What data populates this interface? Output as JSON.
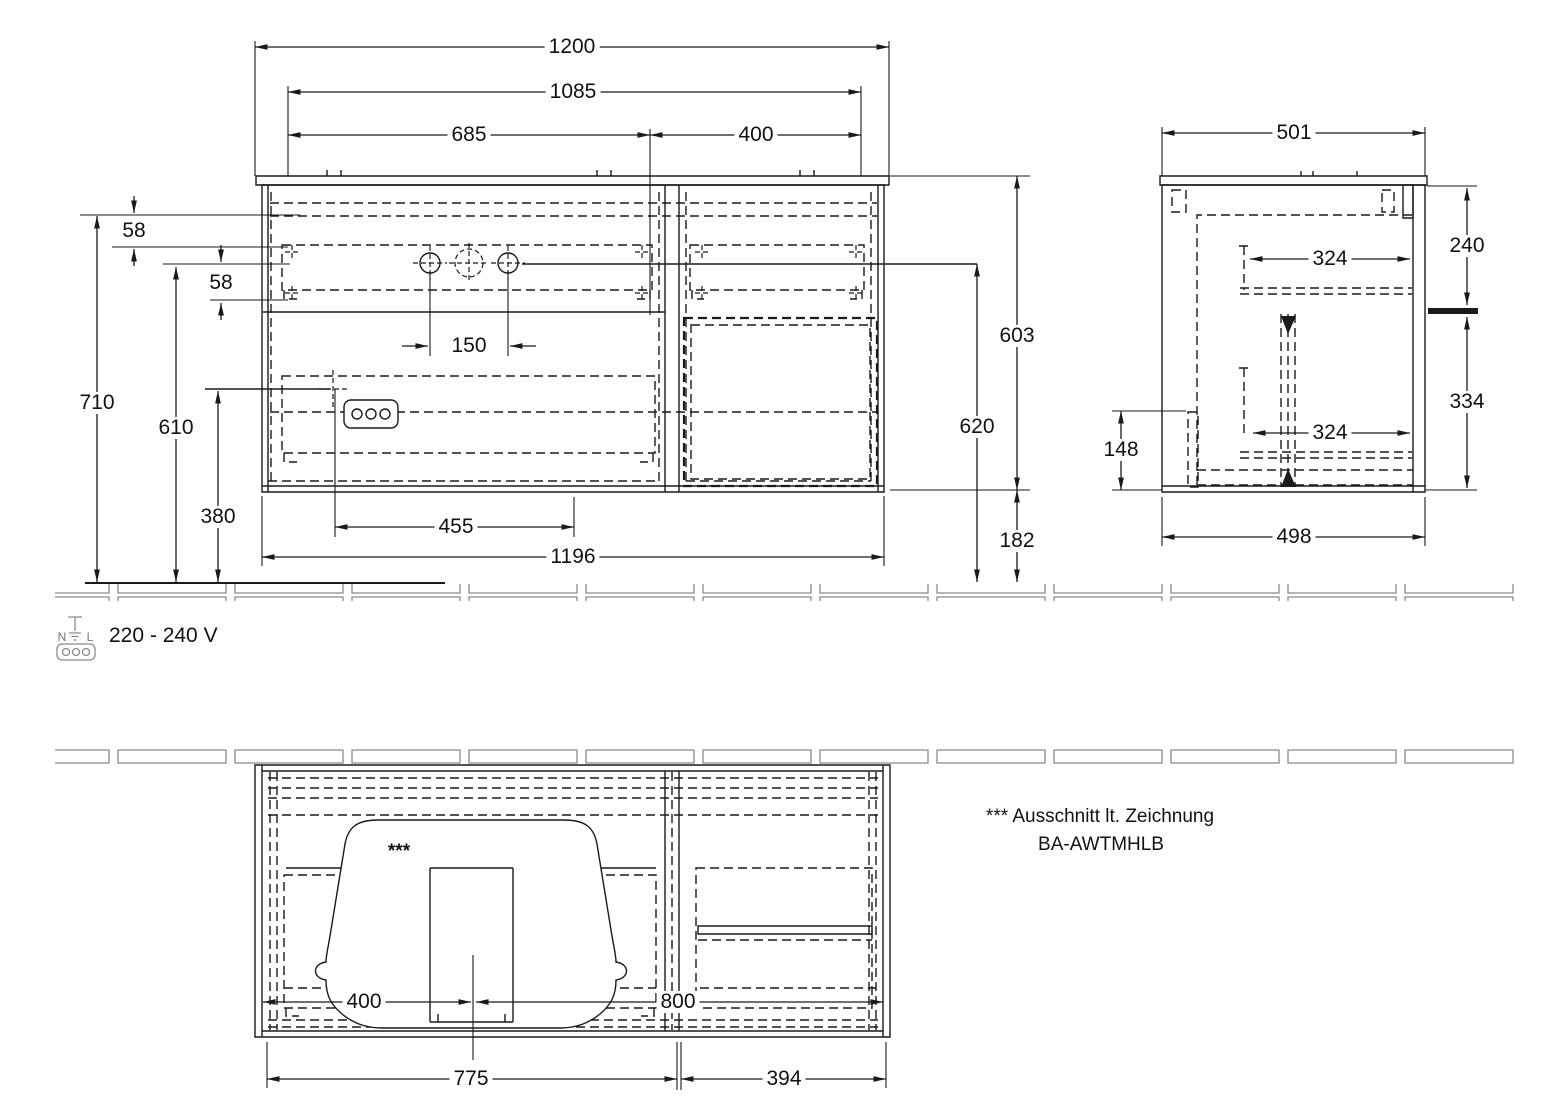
{
  "colors": {
    "line": "#1a1a1a",
    "hatch": "#8a8a8a",
    "background": "#ffffff"
  },
  "front_view": {
    "width_total": "1200",
    "width_inner": "1085",
    "left_section": "685",
    "right_section": "400",
    "gap_top": "58",
    "gap_second": "58",
    "height_total": "710",
    "height_mid": "610",
    "height_socket": "380",
    "hole_spacing": "150",
    "socket_offset": "455",
    "body_width": "1196",
    "body_height": "603",
    "basin_height": "620",
    "bottom_clearance": "182"
  },
  "side_view": {
    "depth_top": "501",
    "upper_section": "240",
    "lower_section": "334",
    "drawer_depth_upper": "324",
    "drawer_depth_lower": "324",
    "lower_gap": "148",
    "depth_bottom": "498"
  },
  "plan_view": {
    "basin_center_offset": "400",
    "center_to_right": "800",
    "left_section_width": "775",
    "right_section_width": "394",
    "cutout_marker": "***"
  },
  "power": {
    "terminal_left": "N",
    "terminal_right": "L",
    "voltage": "220 - 240 V"
  },
  "note": {
    "line1": "*** Ausschnitt lt. Zeichnung",
    "line2": "BA-AWTMHLB"
  }
}
